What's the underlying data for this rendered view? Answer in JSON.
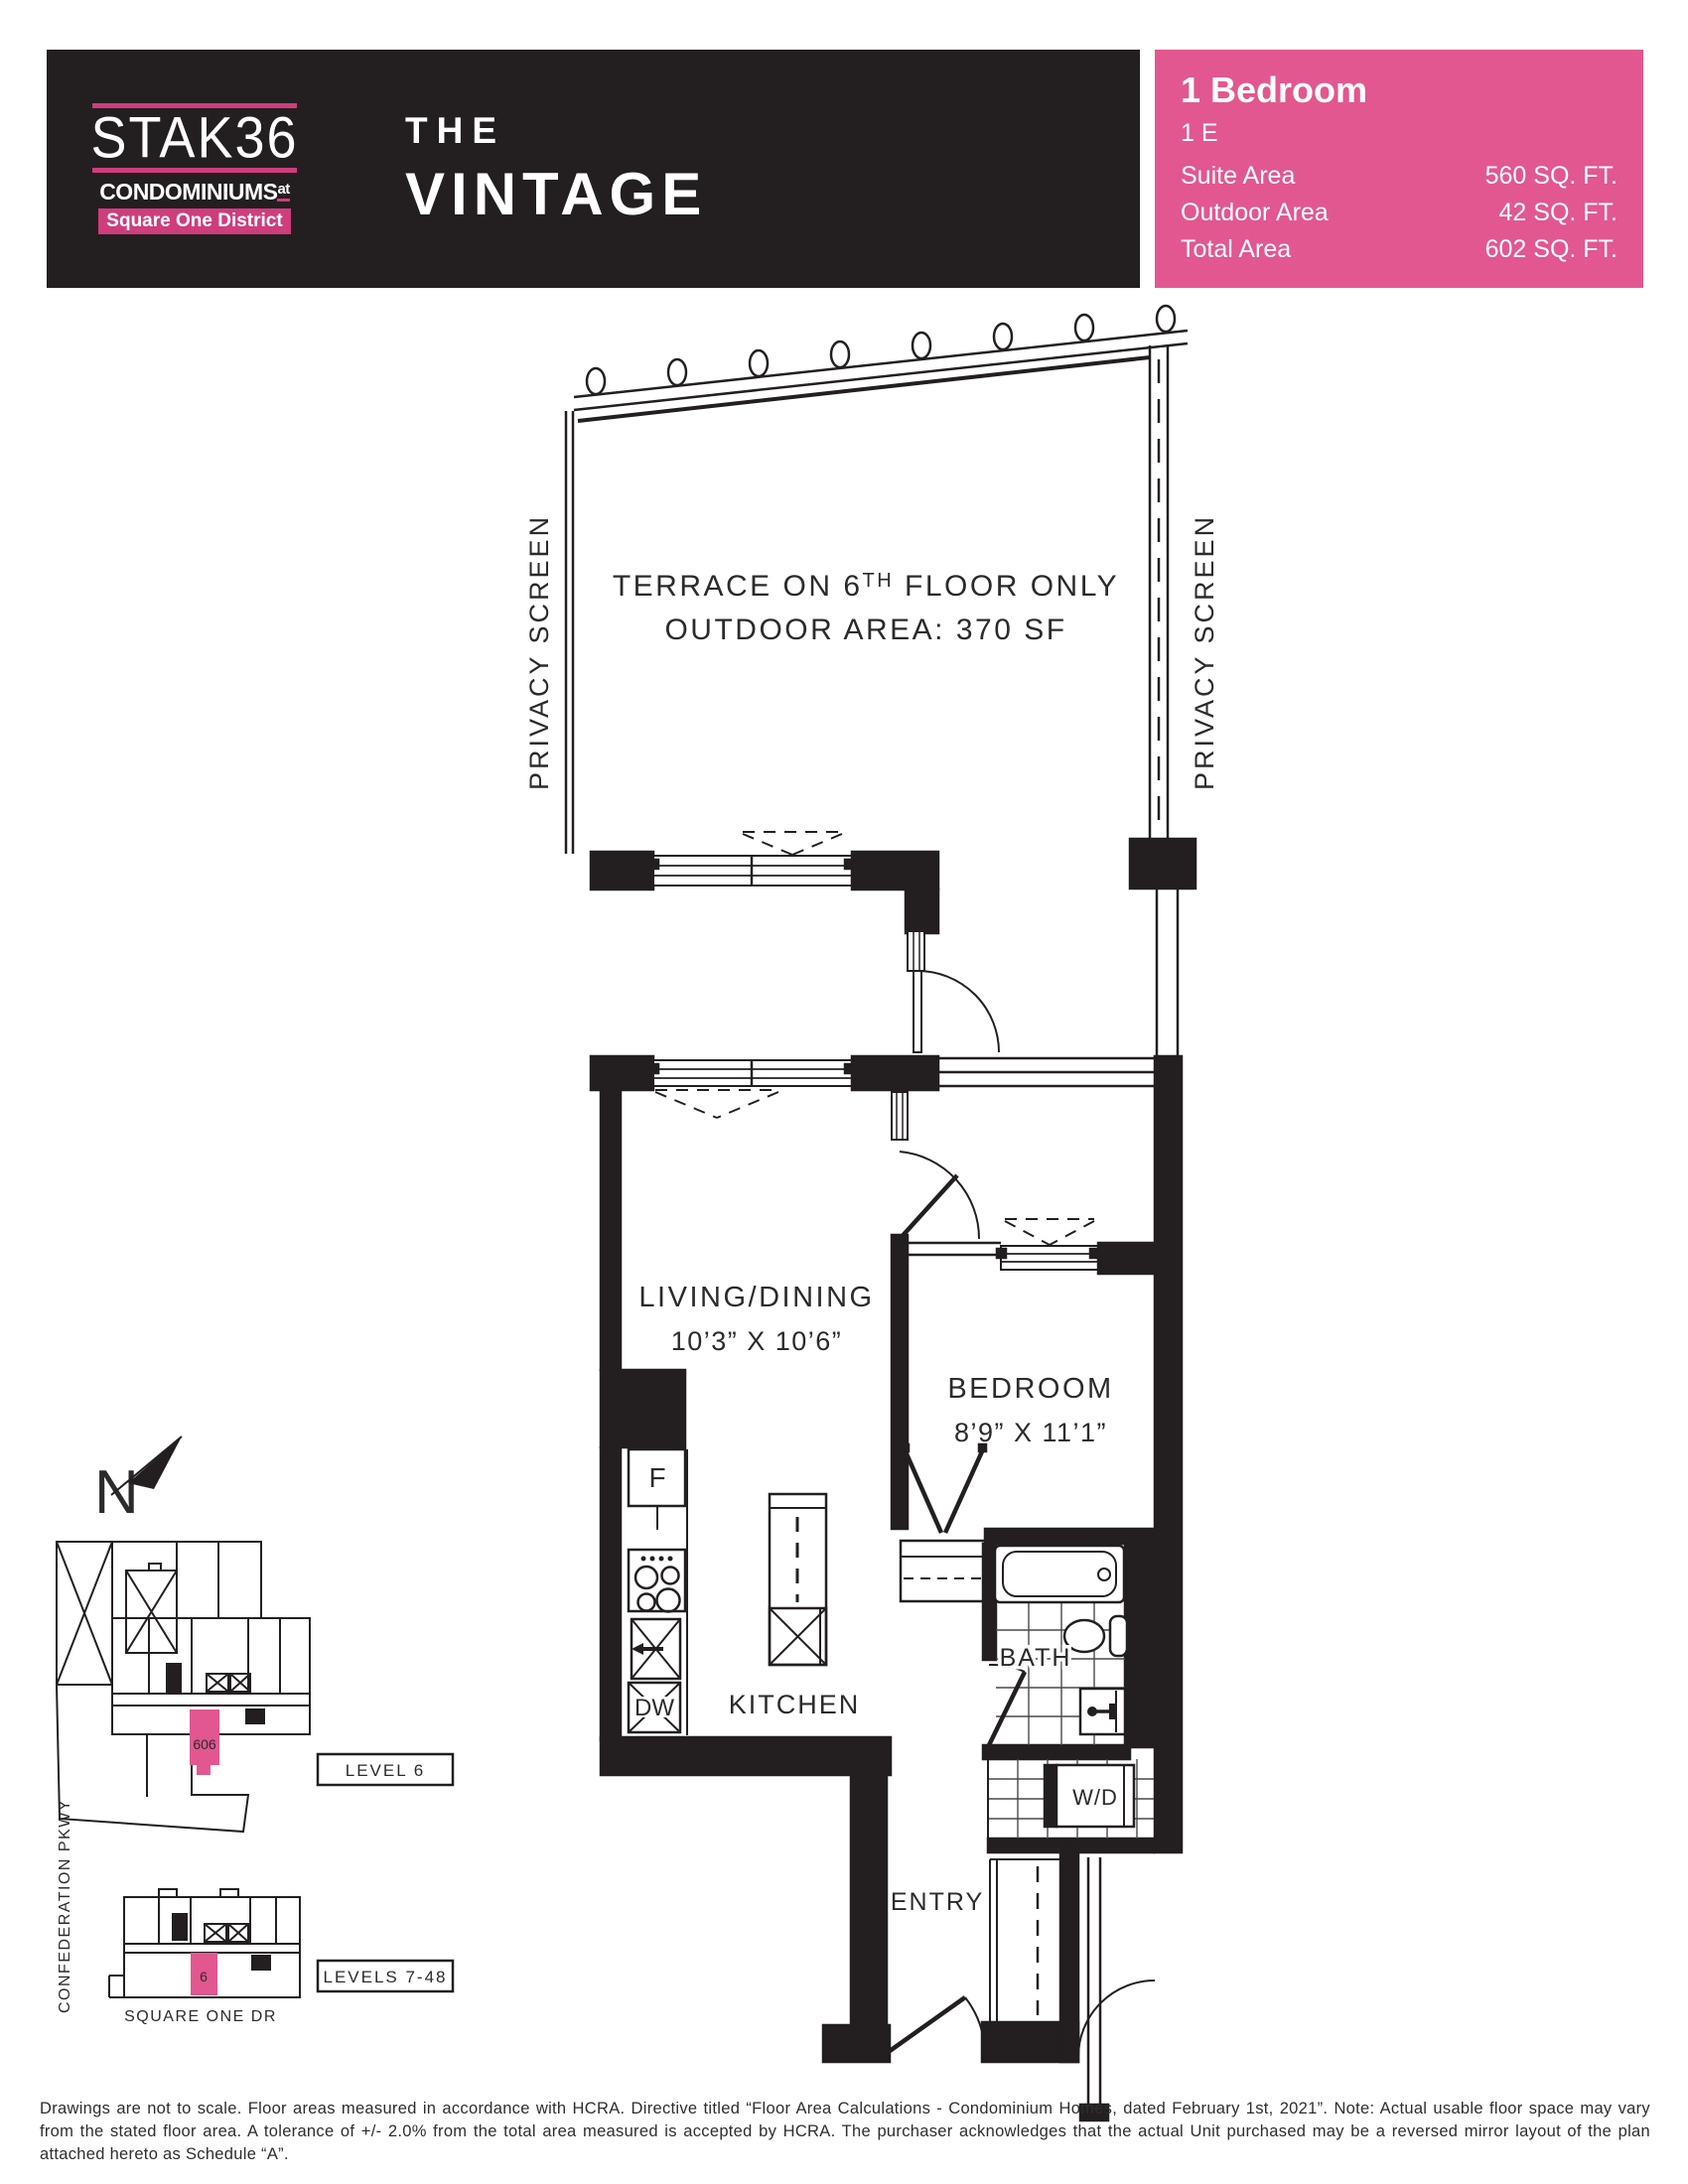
{
  "header": {
    "logo": {
      "brand": "STAK36",
      "sub1": "CONDOMINIUMS",
      "sub1_sup": "at",
      "sub2": "Square One District"
    },
    "title": {
      "line1": "THE",
      "line2": "VINTAGE"
    },
    "info": {
      "type": "1 Bedroom",
      "unit": "1 E",
      "areas": [
        {
          "label": "Suite Area",
          "value": "560 SQ. FT."
        },
        {
          "label": "Outdoor Area",
          "value": "42 SQ. FT."
        },
        {
          "label": "Total Area",
          "value": "602 SQ. FT."
        }
      ]
    }
  },
  "plan": {
    "terrace": {
      "note1a": "TERRACE ON 6",
      "note1sup": "TH",
      "note1b": " FLOOR ONLY",
      "note2": "OUTDOOR AREA: 370 SF",
      "privacy_left": "PRIVACY SCREEN",
      "privacy_right": "PRIVACY SCREEN"
    },
    "living": {
      "name": "LIVING/DINING",
      "dims": "10’3” X 10’6”"
    },
    "bedroom": {
      "name": "BEDROOM",
      "dims": "8’9” X 11’1”"
    },
    "kitchen": {
      "name": "KITCHEN",
      "fridge": "F",
      "dishwasher": "DW"
    },
    "bath": {
      "name": "BATH"
    },
    "laundry": {
      "washer_dryer": "W/D"
    },
    "entry": {
      "name": "ENTRY"
    }
  },
  "keyplan": {
    "compass": "N",
    "level6": {
      "label": "LEVEL 6",
      "unit": "606"
    },
    "levels7_48": {
      "label": "LEVELS 7-48",
      "unit": "6"
    },
    "street_bottom": "SQUARE ONE DR",
    "street_left": "CONFEDERATION PKWY"
  },
  "disclaimer": "Drawings are not to scale. Floor areas measured in accordance with HCRA. Directive titled “Floor Area Calculations - Condominium Homes, dated February 1st, 2021”. Note: Actual usable floor space may vary from the stated floor area. A tolerance of +/- 2.0% from the total area measured is accepted by HCRA. The purchaser acknowledges that the actual Unit purchased may be a reversed mirror layout of the plan attached hereto as Schedule “A”.",
  "colors": {
    "accent_pink": "#e2578f",
    "logo_pink": "#cf3d7c",
    "ink": "#231f20"
  }
}
